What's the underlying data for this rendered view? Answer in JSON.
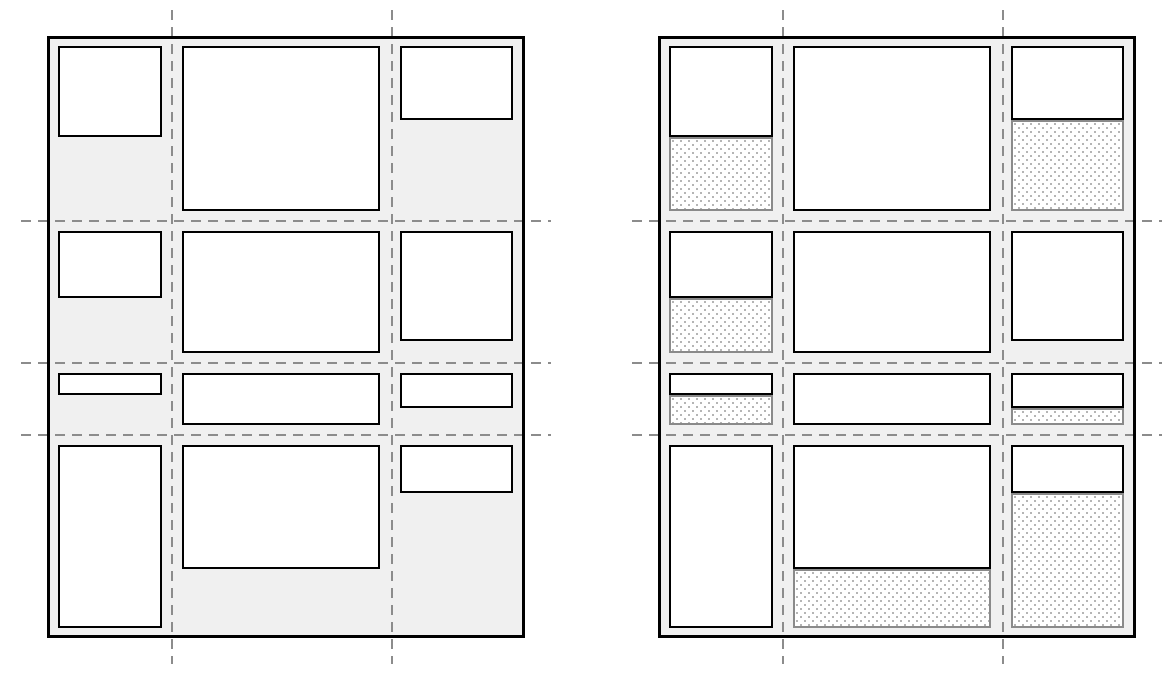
{
  "figure": {
    "canvas": {
      "width": 1171,
      "height": 679,
      "background": "#ffffff"
    },
    "colors": {
      "container_fill": "#f0f0f0",
      "container_border": "#000000",
      "item_fill": "#ffffff",
      "item_border": "#000000",
      "gridline": "#8c8c8c",
      "cell_remainder_border": "#8a8a8a",
      "cell_remainder_dot": "#b5b5b5",
      "cell_remainder_background": "#ffffff"
    },
    "grid": {
      "container": {
        "width": 478,
        "height": 602,
        "border_width": 3
      },
      "columns": [
        {
          "x": 11,
          "w": 104
        },
        {
          "x": 135,
          "w": 198
        },
        {
          "x": 353,
          "w": 113
        }
      ],
      "rows": [
        {
          "y": 10,
          "h": 165
        },
        {
          "y": 195,
          "h": 122
        },
        {
          "y": 337,
          "h": 52
        },
        {
          "y": 409,
          "h": 183
        }
      ],
      "v_lines": [
        125,
        345
      ],
      "h_lines": [
        185,
        327,
        399
      ],
      "line_overhang": 26,
      "dash": {
        "length": 10,
        "gap": 7,
        "thickness": 2
      }
    },
    "items": [
      {
        "row": 0,
        "col": 0,
        "height_fraction": 0.55
      },
      {
        "row": 0,
        "col": 1,
        "height_fraction": 1
      },
      {
        "row": 0,
        "col": 2,
        "height_fraction": 0.45
      },
      {
        "row": 1,
        "col": 0,
        "height_fraction": 0.55
      },
      {
        "row": 1,
        "col": 1,
        "height_fraction": 1
      },
      {
        "row": 1,
        "col": 2,
        "height_fraction": 0.9,
        "show_remainder": false
      },
      {
        "row": 2,
        "col": 0,
        "height_fraction": 0.42
      },
      {
        "row": 2,
        "col": 1,
        "height_fraction": 1
      },
      {
        "row": 2,
        "col": 2,
        "height_fraction": 0.67
      },
      {
        "row": 3,
        "col": 0,
        "height_fraction": 1
      },
      {
        "row": 3,
        "col": 1,
        "height_fraction": 0.68
      },
      {
        "row": 3,
        "col": 2,
        "height_fraction": 0.26
      }
    ],
    "diagrams": [
      {
        "name": "grid-items-figure",
        "x": 47,
        "y": 36,
        "show_cell_remainders": false
      },
      {
        "name": "grid-cells-figure",
        "x": 658,
        "y": 36,
        "show_cell_remainders": true
      }
    ]
  }
}
